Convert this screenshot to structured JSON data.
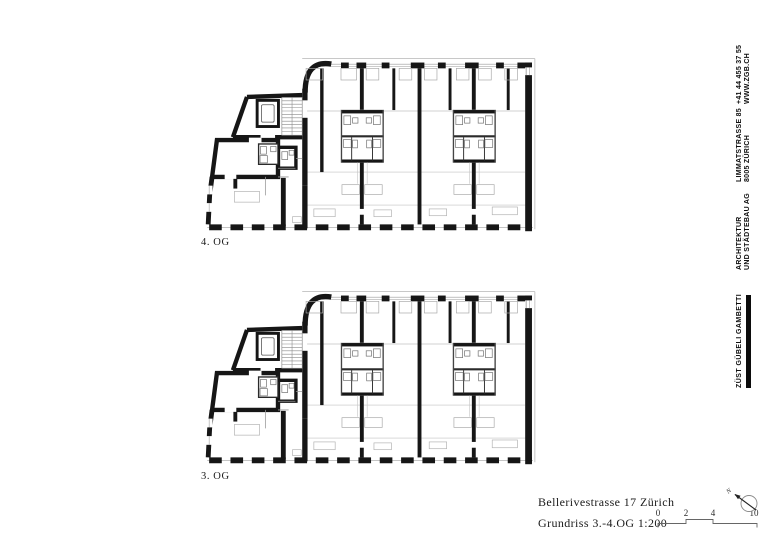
{
  "plans": [
    {
      "label": "4. OG"
    },
    {
      "label": "3. OG"
    }
  ],
  "title_block": {
    "project": "Bellerivestrasse 17 Zürich",
    "drawing": "Grundriss 3.-4.OG 1:200"
  },
  "scale_bar": {
    "ticks": [
      "0",
      "2",
      "4",
      "10"
    ]
  },
  "north": {
    "label": "N"
  },
  "firm": {
    "logo": "ZÜST GÜBELI GAMBETTI",
    "type_line1": "ARCHITEKTUR",
    "type_line2": "UND STÄDTEBAU AG",
    "address_line1": "LIMMATSTRASSE 85",
    "address_line2": "8005 ZÜRICH",
    "phone": "+41 44 455 37 55",
    "website": "WWW.ZGB.CH"
  },
  "colors": {
    "wall": "#161616",
    "thin_line": "#ababab",
    "paper": "#ffffff"
  }
}
